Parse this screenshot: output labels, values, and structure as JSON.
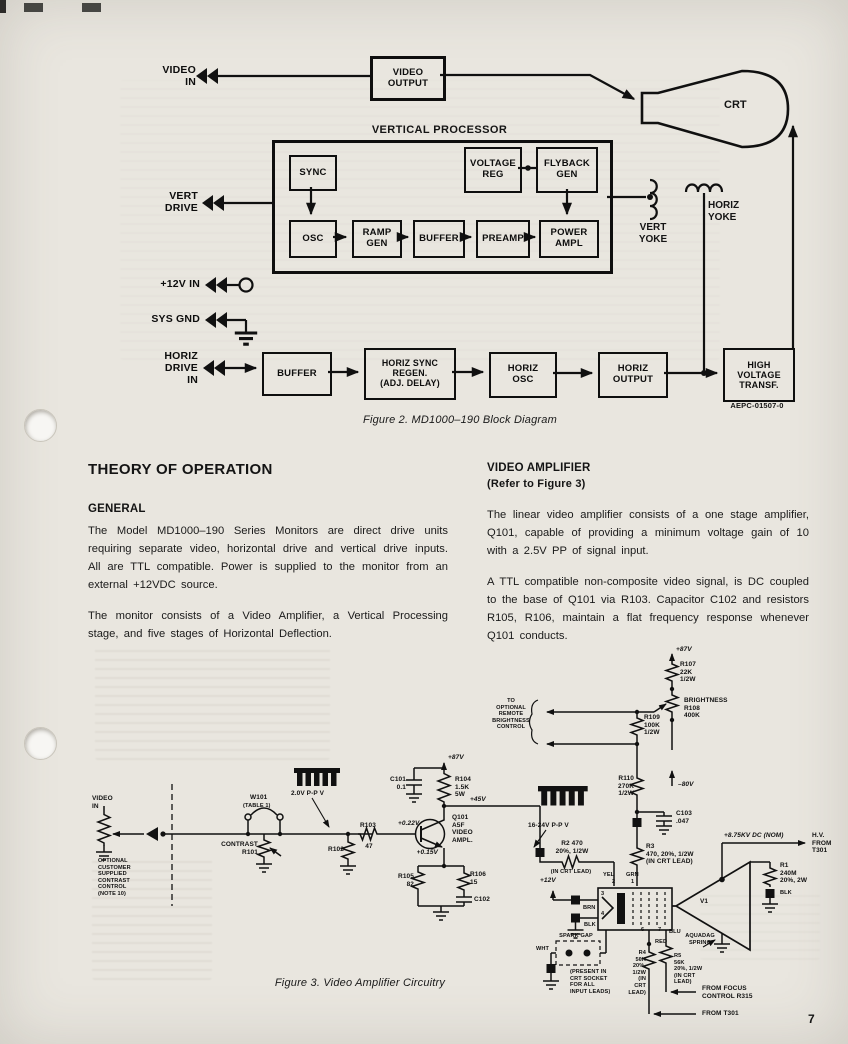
{
  "page": {
    "number": "7"
  },
  "fig2": {
    "caption": "Figure 2.  MD1000–190 Block Diagram",
    "part_no": "AEPC-01507-0",
    "title": "VERTICAL PROCESSOR",
    "io": {
      "video_in": "VIDEO\nIN",
      "vert_drive": "VERT\nDRIVE",
      "p12v": "+12V IN",
      "sys_gnd": "SYS GND",
      "horiz_drive": "HORIZ\nDRIVE\nIN"
    },
    "blocks": {
      "video_output": "VIDEO\nOUTPUT",
      "crt": "CRT",
      "sync": "SYNC",
      "voltage_reg": "VOLTAGE\nREG",
      "flyback_gen": "FLYBACK\nGEN",
      "osc": "OSC",
      "ramp_gen": "RAMP\nGEN",
      "buffer_v": "BUFFER",
      "preamp": "PREAMP",
      "power_ampl": "POWER\nAMPL",
      "buffer_h": "BUFFER",
      "horiz_sync_regen": "HORIZ SYNC\nREGEN.\n(ADJ. DELAY)",
      "horiz_osc": "HORIZ\nOSC",
      "horiz_output": "HORIZ\nOUTPUT",
      "hv_transf": "HIGH\nVOLTAGE\nTRANSF."
    },
    "yokes": {
      "vert": "VERT\nYOKE",
      "horiz": "HORIZ\nYOKE"
    }
  },
  "text": {
    "h1": "THEORY OF OPERATION",
    "general_h": "GENERAL",
    "general_p1": "The Model MD1000–190 Series Monitors are direct drive units requiring separate video, horizontal drive and vertical drive inputs.  All are TTL compatible.  Power is supplied to the monitor from an external +12VDC source.",
    "general_p2": "The monitor consists of a Video Amplifier, a Vertical Processing stage, and five stages of Horizontal Deflection.",
    "va_h": "VIDEO AMPLIFIER",
    "va_sub": "(Refer to Figure 3)",
    "va_p1": "The linear video amplifier consists of a one stage amplifier, Q101, capable of providing a minimum voltage gain of 10 with a 2.5V  PP of signal input.",
    "va_p2": "A TTL compatible non-composite video signal, is DC coupled to the base of Q101 via R103.  Capacitor C102 and resistors R105, R106, maintain a flat frequency response whenever Q101 conducts."
  },
  "fig3": {
    "caption": "Figure 3.  Video Amplifier Circuitry",
    "labels": {
      "video_in": "VIDEO\nIN",
      "opt_contrast": "OPTIONAL\nCUSTOMER\nSUPPLIED\nCONTRAST\nCONTROL\n(NOTE 10)",
      "w101": "W101",
      "w101_table": "(TABLE 1)",
      "contrast": "CONTRAST\nR101",
      "wave1": "2.0V P-P V",
      "r102": "R102",
      "r103": "R103",
      "r103_val": "47",
      "c101": "C101\n0.1",
      "v87_a": "+87V",
      "r104": "R104\n1.5K\n5W",
      "v022": "+0.22V",
      "v015": "+0.15V",
      "v45": "+45V",
      "q101": "Q101\nA5F\nVIDEO\nAMPL.",
      "r105": "R105\n82",
      "r106": "R106\n15",
      "c102": "C102",
      "v87_b": "+87V",
      "r107": "R107\n22K\n1/2W",
      "brightness": "BRIGHTNESS\nR108\n400K",
      "r109": "R109\n100K\n1/2W",
      "remote": "TO\nOPTIONAL\nREMOTE\nBRIGHTNESS\nCONTROL",
      "r110": "R110\n270K\n1/2W",
      "vm80": "–80V",
      "c103": "C103\n.047",
      "wave2": "16-24V P-P V",
      "r2": "R2 470\n20%, 1/2W",
      "r2_note": "(IN CRT LEAD)",
      "r3": "R3\n470, 20%, 1/2W\n(IN CRT LEAD)",
      "v12": "+12V",
      "yel": "YEL",
      "grn": "GRN",
      "brn": "BRN",
      "blk_a": "BLK",
      "red": "RED",
      "blu": "BLU",
      "wht": "WHT",
      "blk_b": "BLK",
      "pin1": "1",
      "pin2": "2",
      "pin3": "3",
      "pin4": "4",
      "pin6": "6",
      "pin7": "7",
      "v1": "V1",
      "aquadag": "AQUADAG\nSPRING",
      "hv": "+8.75KV DC (NOM)",
      "hv_from": "H.V.\nFROM\nT301",
      "r1": "R1\n240M\n20%, 2W",
      "spark": "SPARK GAP",
      "spark_note": "(PRESENT IN\nCRT SOCKET\nFOR ALL\nINPUT LEADS)",
      "r4": "R4\n56K\n20%,\n1/2W\n(IN\nCRT\nLEAD)",
      "r5": "R5\n56K\n20%, 1/2W\n(IN CRT\nLEAD)",
      "from_focus": "FROM FOCUS\nCONTROL R315",
      "from_t301": "FROM T301"
    }
  }
}
